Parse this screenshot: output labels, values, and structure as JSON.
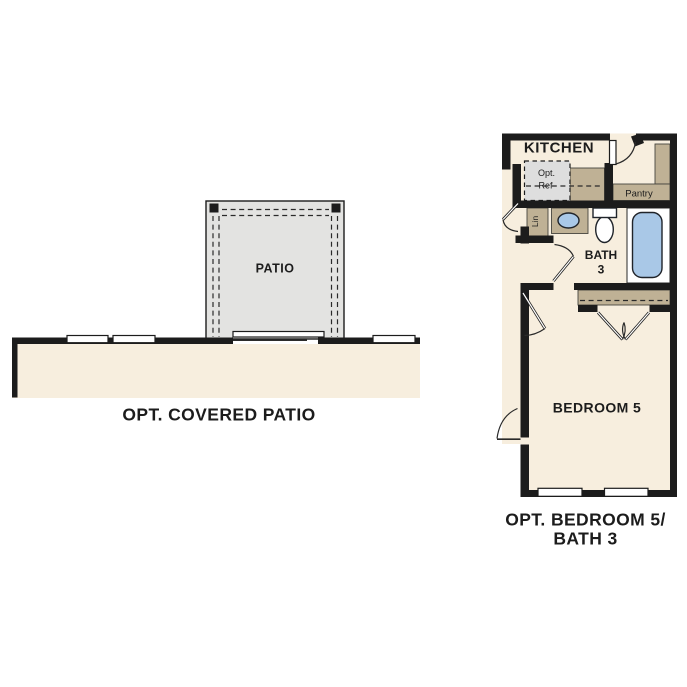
{
  "title": "Optional floor plan details",
  "colors": {
    "cream": "#f7eede",
    "patio_gray": "#e3e3e1",
    "ref_gray": "#dedede",
    "tan": "#bfb195",
    "fixture_blue": "#a9c8e7",
    "wall": "#1c1c1c",
    "line": "#2a2a2a",
    "text": "#1c1c1c"
  },
  "left_plan": {
    "room_label": "PATIO",
    "caption": "OPT. COVERED PATIO"
  },
  "right_plan": {
    "rooms": {
      "kitchen": "KITCHEN",
      "opt_ref_line1": "Opt.",
      "opt_ref_line2": "Ref",
      "pantry": "Pantry",
      "linen": "Lin",
      "bath_line1": "BATH",
      "bath_line2": "3",
      "bedroom": "BEDROOM 5"
    },
    "caption_line1": "OPT. BEDROOM 5/",
    "caption_line2": "BATH 3"
  }
}
